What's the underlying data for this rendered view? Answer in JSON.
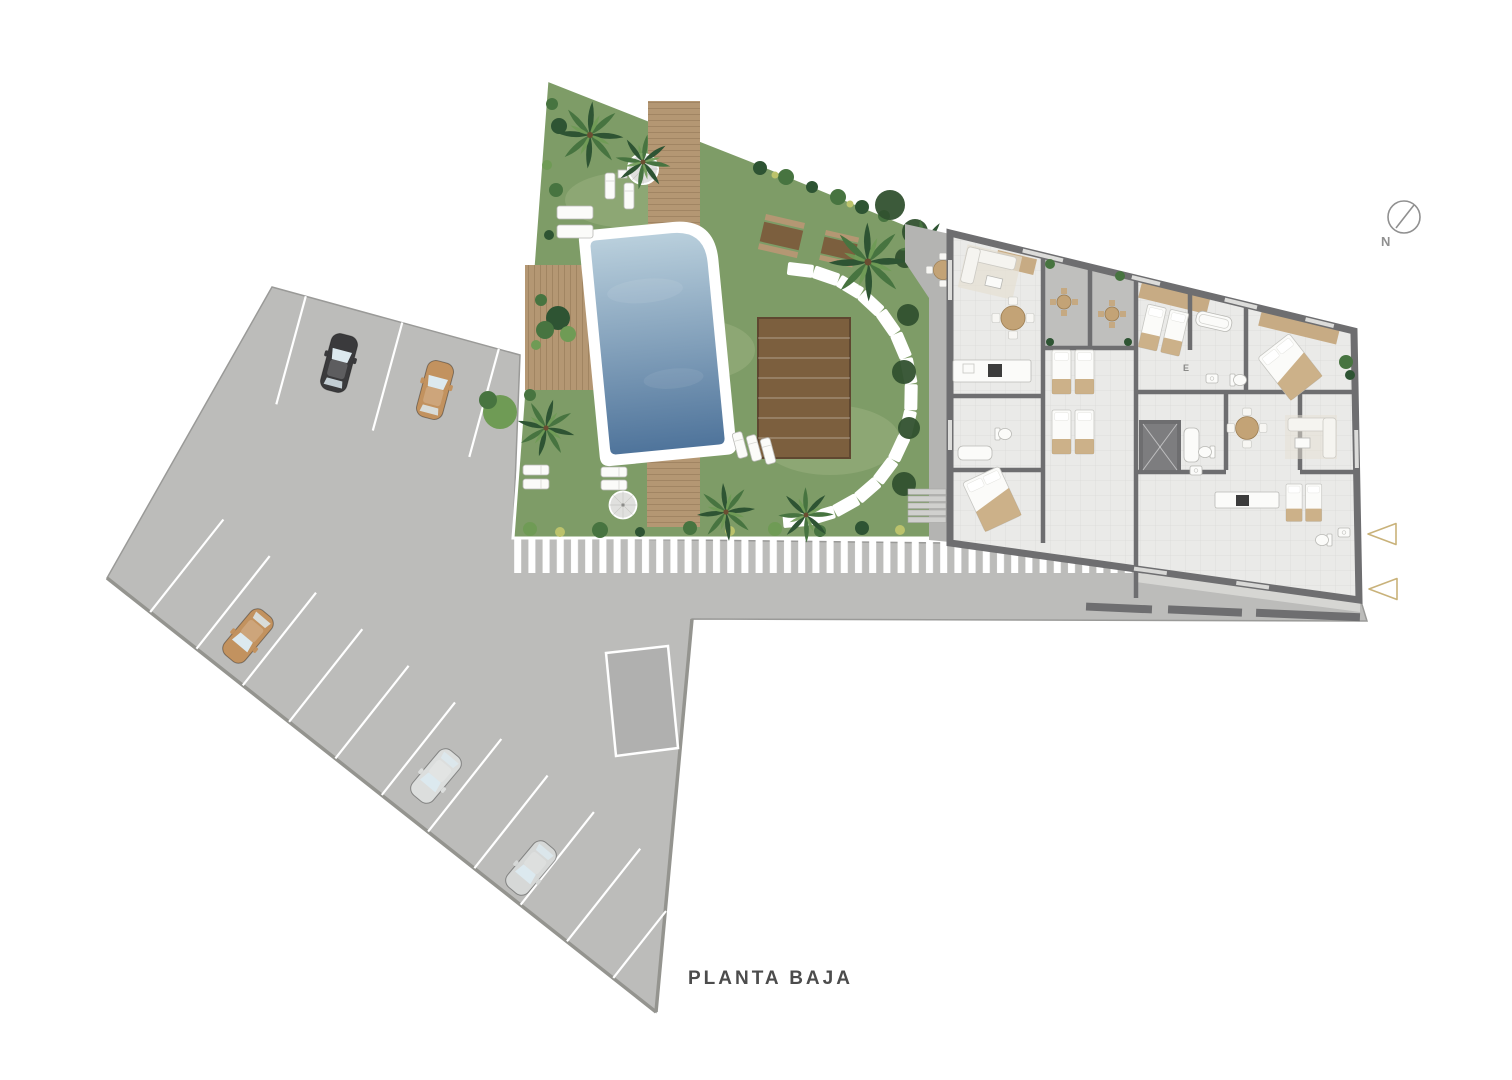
{
  "title": "PLANTA BAJA",
  "compass": {
    "label": "N"
  },
  "building": {
    "elevator_label": "E"
  },
  "entry_arrows": {
    "count": 2,
    "direction": "left"
  },
  "parking": {
    "top_row_lines": 3,
    "bottom_row_lines": 11
  },
  "cars": [
    {
      "name": "car-top-black",
      "color": "#3a3a3c"
    },
    {
      "name": "car-top-tan",
      "color": "#c2925f"
    },
    {
      "name": "car-bottom-tan",
      "color": "#c2925f"
    },
    {
      "name": "car-bottom-silver",
      "color": "#dcdedd"
    },
    {
      "name": "car-bottom-silver2",
      "color": "#d6d8d7"
    }
  ],
  "colors": {
    "page_bg": "#ffffff",
    "parking": "#bcbcba",
    "parking_edge": "#9a9a98",
    "stripe": "#ffffff",
    "grass": "#7e9c67",
    "grass_light": "#a8bd8d",
    "garden_border": "#ffffff",
    "pool_top": "#b9cfdc",
    "pool_bottom": "#4f749b",
    "deck": "#b49773",
    "deck_dark": "#7c5f3e",
    "plank_line": "#6d5436",
    "stone": "#ffffff",
    "terrace": "#b4b4b2",
    "wall": "#6e6e70",
    "floor": "#eaeae8",
    "floor_grid": "#dadad8",
    "patio_floor": "#bfbfbd",
    "balcony_wood": "#c5a87e",
    "furn_beige": "#e5dfd3",
    "furn_tan": "#c3a376",
    "palm_dark": "#2e5433",
    "palm_mid": "#477440",
    "palm_light": "#6f9b55",
    "bush_yellow": "#bcc36c",
    "tree_dark": "#31512f",
    "accent_gold": "#c9b27a",
    "compass_gray": "#909090",
    "title_text": "#4c4c4c",
    "car_window": "#dce9ef"
  }
}
